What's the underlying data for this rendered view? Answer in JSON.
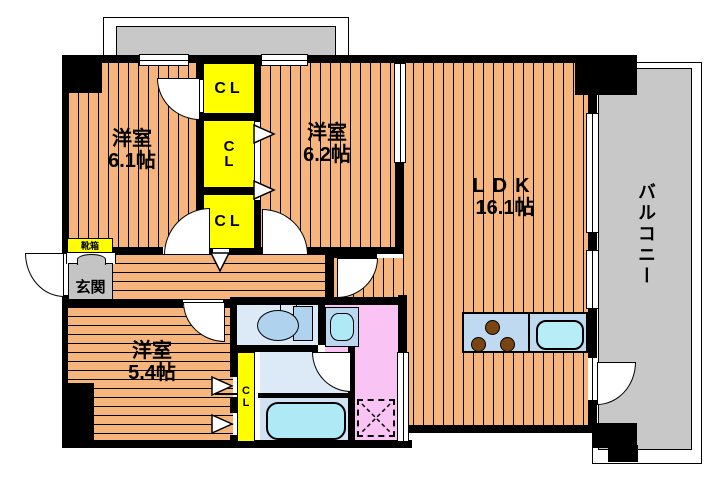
{
  "plan": {
    "type": "apartment-floor-plan",
    "rooms": [
      {
        "id": "room-6-1",
        "name": "洋室",
        "size": "6.1帖"
      },
      {
        "id": "room-6-2",
        "name": "洋室",
        "size": "6.2帖"
      },
      {
        "id": "ldk",
        "name": "LDK",
        "size": "16.1帖"
      },
      {
        "id": "room-5-4",
        "name": "洋室",
        "size": "5.4帖"
      }
    ],
    "balcony_label": "バルコニー",
    "entrance_label": "玄関",
    "shoe_box_label": "靴箱",
    "closet_label": "CL",
    "closet_letters": {
      "c": "C",
      "l": "L"
    },
    "fixtures": [
      "toilet",
      "washbasin",
      "bathtub",
      "kitchen-counter",
      "gas-burners",
      "kitchen-sink",
      "washing-machine-pan"
    ],
    "colors": {
      "wood_floor": "#F5B57D",
      "closet_yellow": "#FFFF00",
      "balcony_gray": "#C8C8C8",
      "entrance_gray": "#C4C4C4",
      "water_room_blue": "#DCEAF8",
      "fixture_blue": "#AFD3EE",
      "tub_cyan": "#AEE9F5",
      "counter_blue": "#BFD9F0",
      "washroom_pink": "#F9C4F4",
      "burner_brown": "#7B4513",
      "wall_black": "#000000"
    }
  }
}
